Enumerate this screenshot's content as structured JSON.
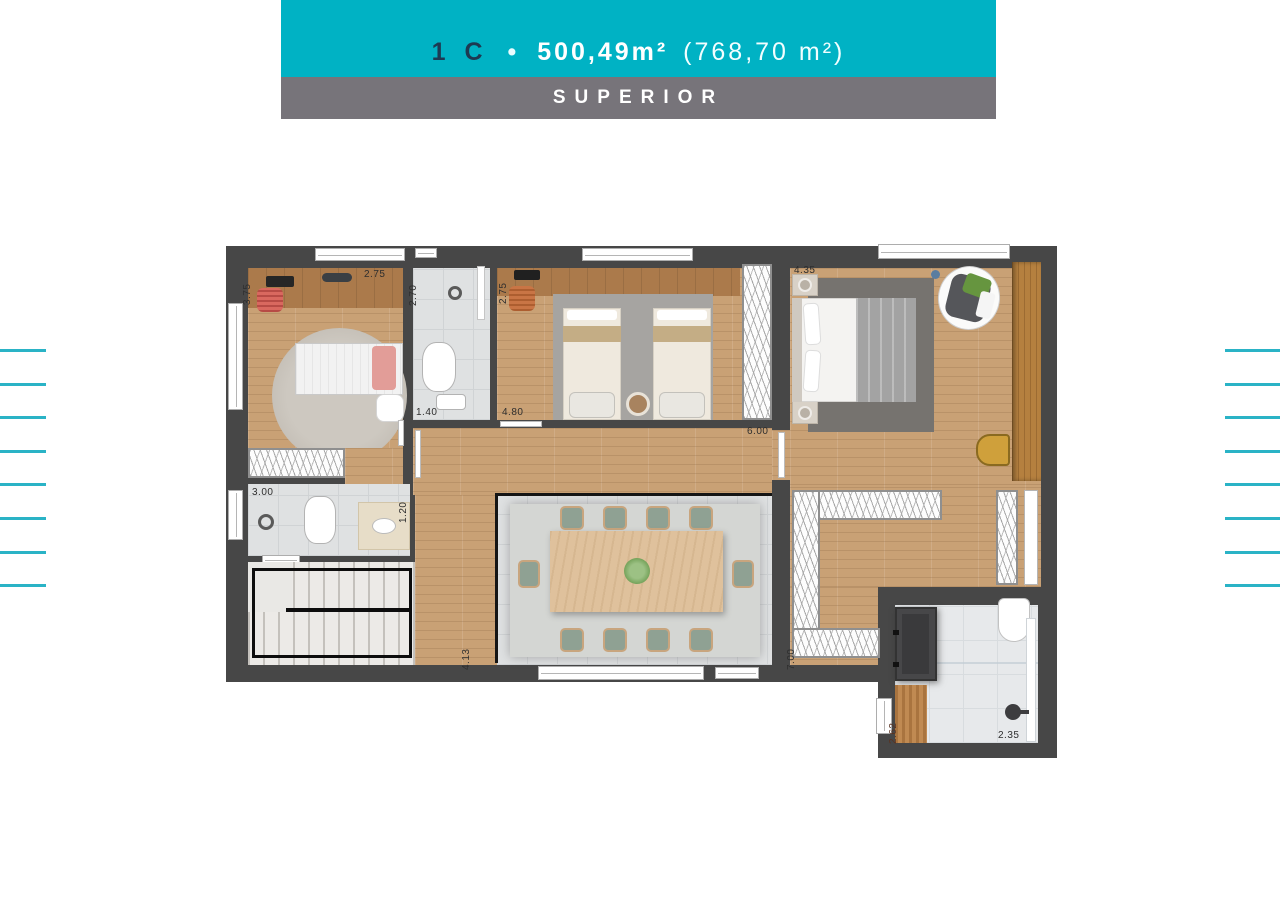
{
  "header": {
    "unit": "1 C",
    "separator": "•",
    "private_area": "500,49m²",
    "total_area": "(768,70 m²)",
    "level": "SUPERIOR"
  },
  "dimensions": {
    "bedroom1_depth": "3.75",
    "bedroom1_width": "2.75",
    "bath1_depth": "2.70",
    "bedroom2_depth": "2.75",
    "master_width": "4.35",
    "bath1_width": "1.40",
    "bedroom2_width": "4.80",
    "hall_width": "6.00",
    "service_bath_width": "3.00",
    "service_bath_depth": "1.20",
    "corridor_depth": "4.13",
    "closet_depth": "7.00",
    "master_bath_deck_width": "2.62",
    "master_bath_width": "2.35"
  },
  "decor": {
    "side_line_count": 8,
    "side_line_step": 33.6
  },
  "colors": {
    "accent_cyan": "#00b2c4",
    "band_gray": "#77747a",
    "line_cyan": "#2ab3c6",
    "wall": "#474747",
    "wood": "#c9a175",
    "tile": "#dfe1e2",
    "unit_text": "#1d3a52"
  }
}
